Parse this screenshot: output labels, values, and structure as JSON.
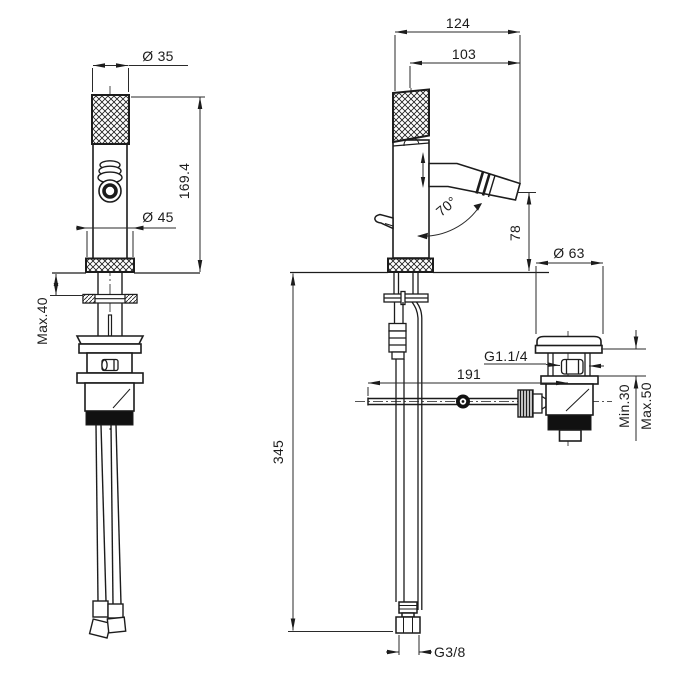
{
  "drawing": {
    "kind": "technical-dimension-drawing",
    "subject": "single-lever bidet mixer with pop-up waste, front and side views",
    "colors": {
      "line": "#1c1c1c",
      "background": "#ffffff",
      "fill_dark": "#111111"
    },
    "dimensions": {
      "front": {
        "top_diameter": "Ø 35",
        "body_height": "169.4",
        "base_diameter": "Ø 45",
        "deck_max": "Max.40"
      },
      "side": {
        "total_depth": "124",
        "spout_reach": "103",
        "spout_angle": "70°",
        "spout_height": "78",
        "waste_cap_diameter": "Ø 63",
        "waste_thread": "G1.1/4",
        "rod_length": "191",
        "counter_min": "Min.30",
        "counter_max": "Max.50",
        "hose_drop": "345",
        "supply_thread": "G3/8"
      }
    }
  }
}
